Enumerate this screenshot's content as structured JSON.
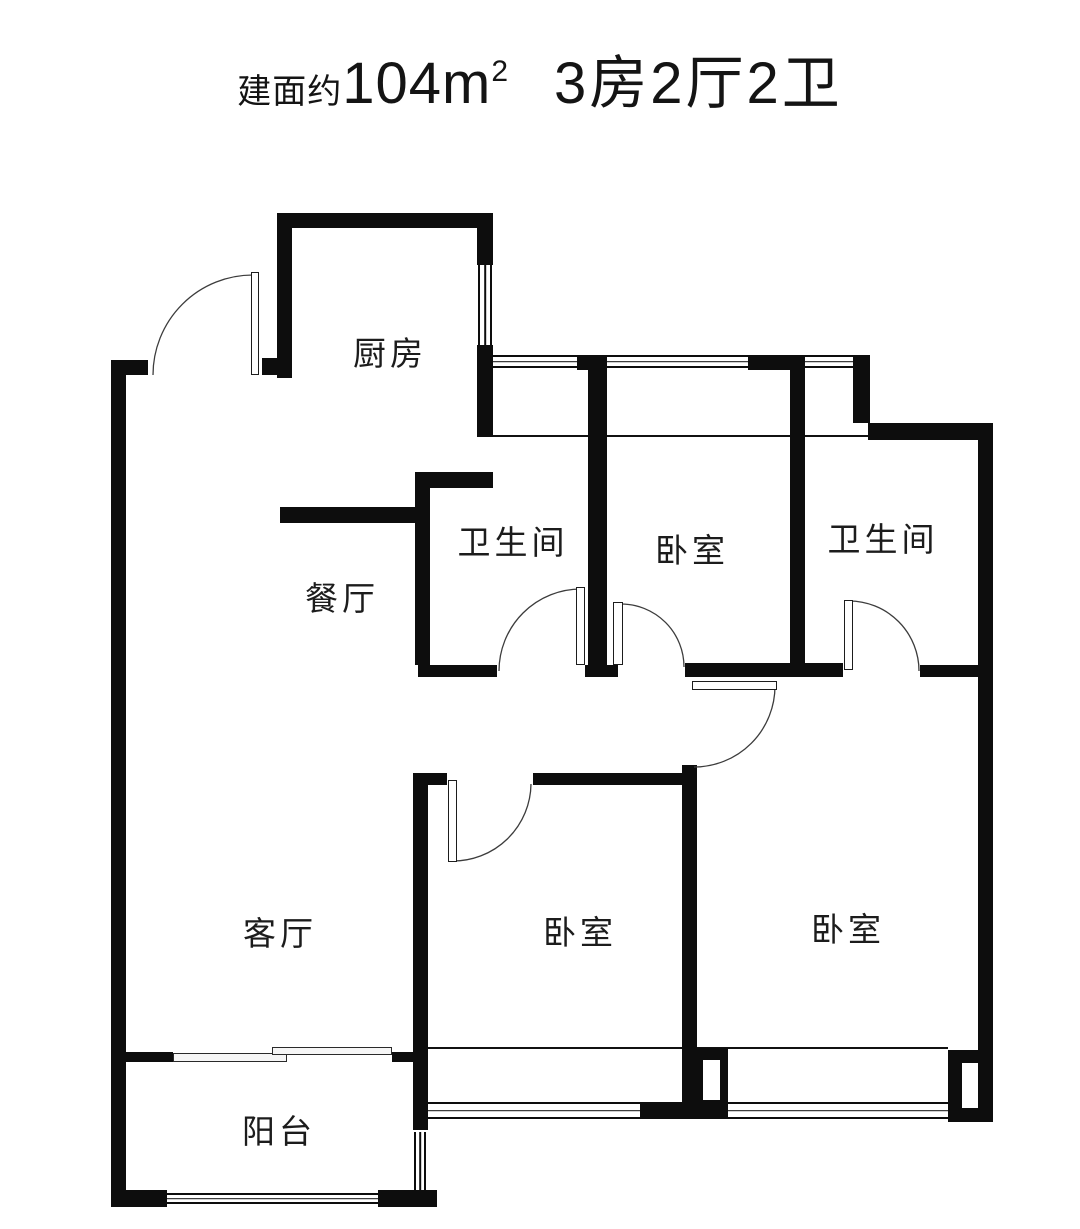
{
  "title": {
    "prefix": "建面约",
    "area_value": "104m",
    "area_sup": "2",
    "layout": "3房2厅2卫"
  },
  "colors": {
    "wall": "#0d0d0d",
    "text": "#141414",
    "label": "#1c1c1c",
    "arc": "#3c3c3c"
  },
  "rooms": [
    {
      "id": "kitchen",
      "label": "厨房",
      "cx": 390,
      "cy": 351
    },
    {
      "id": "dining",
      "label": "餐厅",
      "cx": 342,
      "cy": 596
    },
    {
      "id": "bathroom-north-west",
      "label": "卫生间",
      "cx": 513,
      "cy": 540
    },
    {
      "id": "bedroom-north",
      "label": "卧室",
      "cx": 692,
      "cy": 548
    },
    {
      "id": "bathroom-north-east",
      "label": "卫生间",
      "cx": 883,
      "cy": 537
    },
    {
      "id": "living-room",
      "label": "客厅",
      "cx": 280,
      "cy": 931
    },
    {
      "id": "bedroom-south-middle",
      "label": "卧室",
      "cx": 580,
      "cy": 930
    },
    {
      "id": "bedroom-south-east",
      "label": "卧室",
      "cx": 848,
      "cy": 927
    },
    {
      "id": "balcony",
      "label": "阳台",
      "cx": 279,
      "cy": 1129
    }
  ],
  "floorplan": {
    "width": 1080,
    "height": 1229,
    "walls": [
      {
        "name": "left-outer-wall",
        "x": 111,
        "y": 360,
        "w": 15,
        "h": 847
      },
      {
        "name": "entry-left-stub",
        "x": 111,
        "y": 360,
        "w": 37,
        "h": 15
      },
      {
        "name": "kitchen-top-wall",
        "x": 277,
        "y": 213,
        "w": 216,
        "h": 15
      },
      {
        "name": "kitchen-left-wall",
        "x": 277,
        "y": 213,
        "w": 15,
        "h": 165
      },
      {
        "name": "entry-right-stub",
        "x": 262,
        "y": 358,
        "w": 30,
        "h": 17
      },
      {
        "name": "kitchen-right-wall-upper",
        "x": 477,
        "y": 213,
        "w": 16,
        "h": 52
      },
      {
        "name": "kitchen-right-wall-lower",
        "x": 477,
        "y": 345,
        "w": 16,
        "h": 92
      },
      {
        "name": "kitchen-bottom-wall",
        "x": 280,
        "y": 507,
        "w": 137,
        "h": 16
      },
      {
        "name": "bath1-top-wall",
        "x": 415,
        "y": 472,
        "w": 78,
        "h": 16
      },
      {
        "name": "bath1-left-wall",
        "x": 415,
        "y": 472,
        "w": 15,
        "h": 193
      },
      {
        "name": "bath1-bottom-wall",
        "x": 418,
        "y": 665,
        "w": 79,
        "h": 12
      },
      {
        "name": "hall-wall-a-top-pier",
        "x": 577,
        "y": 355,
        "w": 30,
        "h": 15
      },
      {
        "name": "hall-wall-a",
        "x": 588,
        "y": 358,
        "w": 19,
        "h": 319
      },
      {
        "name": "hall-wall-a-foot",
        "x": 585,
        "y": 665,
        "w": 33,
        "h": 12
      },
      {
        "name": "hall-wall-b-top-pier",
        "x": 748,
        "y": 355,
        "w": 57,
        "h": 15
      },
      {
        "name": "hall-wall-b",
        "x": 790,
        "y": 367,
        "w": 15,
        "h": 310
      },
      {
        "name": "north-east-pier",
        "x": 853,
        "y": 355,
        "w": 17,
        "h": 68
      },
      {
        "name": "north-east-wall",
        "x": 868,
        "y": 423,
        "w": 125,
        "h": 17
      },
      {
        "name": "bed1-bottom-wall",
        "x": 685,
        "y": 663,
        "w": 158,
        "h": 14
      },
      {
        "name": "bath2-bottom-wall-right",
        "x": 920,
        "y": 665,
        "w": 60,
        "h": 12
      },
      {
        "name": "right-outer-wall",
        "x": 978,
        "y": 423,
        "w": 15,
        "h": 699
      },
      {
        "name": "bed2-left-wall",
        "x": 682,
        "y": 765,
        "w": 15,
        "h": 338
      },
      {
        "name": "bed3-top-wall",
        "x": 533,
        "y": 773,
        "w": 152,
        "h": 12
      },
      {
        "name": "bed3-top-stub",
        "x": 415,
        "y": 773,
        "w": 32,
        "h": 12
      },
      {
        "name": "bed3-left-wall",
        "x": 413,
        "y": 773,
        "w": 15,
        "h": 357
      },
      {
        "name": "south-window-mid-block",
        "x": 640,
        "y": 1102,
        "w": 88,
        "h": 16
      },
      {
        "name": "south-center-pier",
        "x": 697,
        "y": 1048,
        "w": 31,
        "h": 56
      },
      {
        "name": "south-east-corner-block",
        "x": 948,
        "y": 1050,
        "w": 45,
        "h": 72
      },
      {
        "name": "balcony-divider-left",
        "x": 120,
        "y": 1052,
        "w": 53,
        "h": 10
      },
      {
        "name": "balcony-divider-right",
        "x": 392,
        "y": 1052,
        "w": 21,
        "h": 10
      },
      {
        "name": "balcony-bottom-left-wall",
        "x": 111,
        "y": 1190,
        "w": 56,
        "h": 17
      },
      {
        "name": "balcony-bottom-right-wall",
        "x": 378,
        "y": 1190,
        "w": 59,
        "h": 17
      },
      {
        "name": "balcony-right-foot",
        "x": 400,
        "y": 1192,
        "w": 30,
        "h": 15
      }
    ],
    "notches": [
      {
        "name": "south-center-pier-notch",
        "x": 703,
        "y": 1060,
        "w": 17,
        "h": 40
      },
      {
        "name": "south-east-corner-notch",
        "x": 962,
        "y": 1063,
        "w": 16,
        "h": 45
      }
    ],
    "windows_h": [
      {
        "name": "north-window-band",
        "x": 493,
        "y": 355,
        "w": 360,
        "h": 13
      },
      {
        "name": "south-window-band",
        "x": 428,
        "y": 1102,
        "w": 520,
        "h": 17
      },
      {
        "name": "balcony-south-window",
        "x": 167,
        "y": 1193,
        "w": 211,
        "h": 11
      }
    ],
    "windows_v": [
      {
        "name": "kitchen-east-window",
        "x": 478,
        "y": 265,
        "w": 14,
        "h": 80
      },
      {
        "name": "balcony-east-window",
        "x": 414,
        "y": 1132,
        "w": 12,
        "h": 60
      }
    ],
    "lines": [
      {
        "name": "north-sill-line",
        "x": 480,
        "y": 435,
        "w": 388,
        "h": 2
      },
      {
        "name": "south-sill-line",
        "x": 428,
        "y": 1047,
        "w": 520,
        "h": 2
      }
    ],
    "sliding_panels": [
      {
        "name": "balcony-sliding-panel-left",
        "x": 173,
        "y": 1053,
        "w": 114,
        "h": 9
      },
      {
        "name": "balcony-sliding-panel-right",
        "x": 272,
        "y": 1047,
        "w": 120,
        "h": 8
      }
    ],
    "door_leaves": [
      {
        "name": "entry-door-leaf",
        "x": 251,
        "y": 272,
        "w": 8,
        "h": 103
      },
      {
        "name": "bath1-door-leaf",
        "x": 576,
        "y": 587,
        "w": 9,
        "h": 78
      },
      {
        "name": "bed1-door-leaf",
        "x": 613,
        "y": 602,
        "w": 10,
        "h": 63
      },
      {
        "name": "bath2-door-leaf",
        "x": 844,
        "y": 600,
        "w": 9,
        "h": 70
      },
      {
        "name": "bed2-door-leaf",
        "x": 692,
        "y": 681,
        "w": 85,
        "h": 9
      },
      {
        "name": "bed3-door-leaf",
        "x": 448,
        "y": 780,
        "w": 9,
        "h": 82
      }
    ],
    "door_arcs": [
      {
        "name": "entry-door-arc",
        "d": "M 153 375 A 100 100 0 0 1 253 275"
      },
      {
        "name": "bath1-door-arc",
        "d": "M 499 671 A 82 82 0 0 1 581 589"
      },
      {
        "name": "bed1-door-arc",
        "d": "M 621 604 A 63 63 0 0 1 684 667"
      },
      {
        "name": "bath2-door-arc",
        "d": "M 849 601 A 70 70 0 0 1 919 671"
      },
      {
        "name": "bed2-door-arc",
        "d": "M 775 686 A 81 81 0 0 1 694 767"
      },
      {
        "name": "bed3-door-arc",
        "d": "M 452 861 A 78 78 0 0 0 531 784"
      }
    ]
  }
}
